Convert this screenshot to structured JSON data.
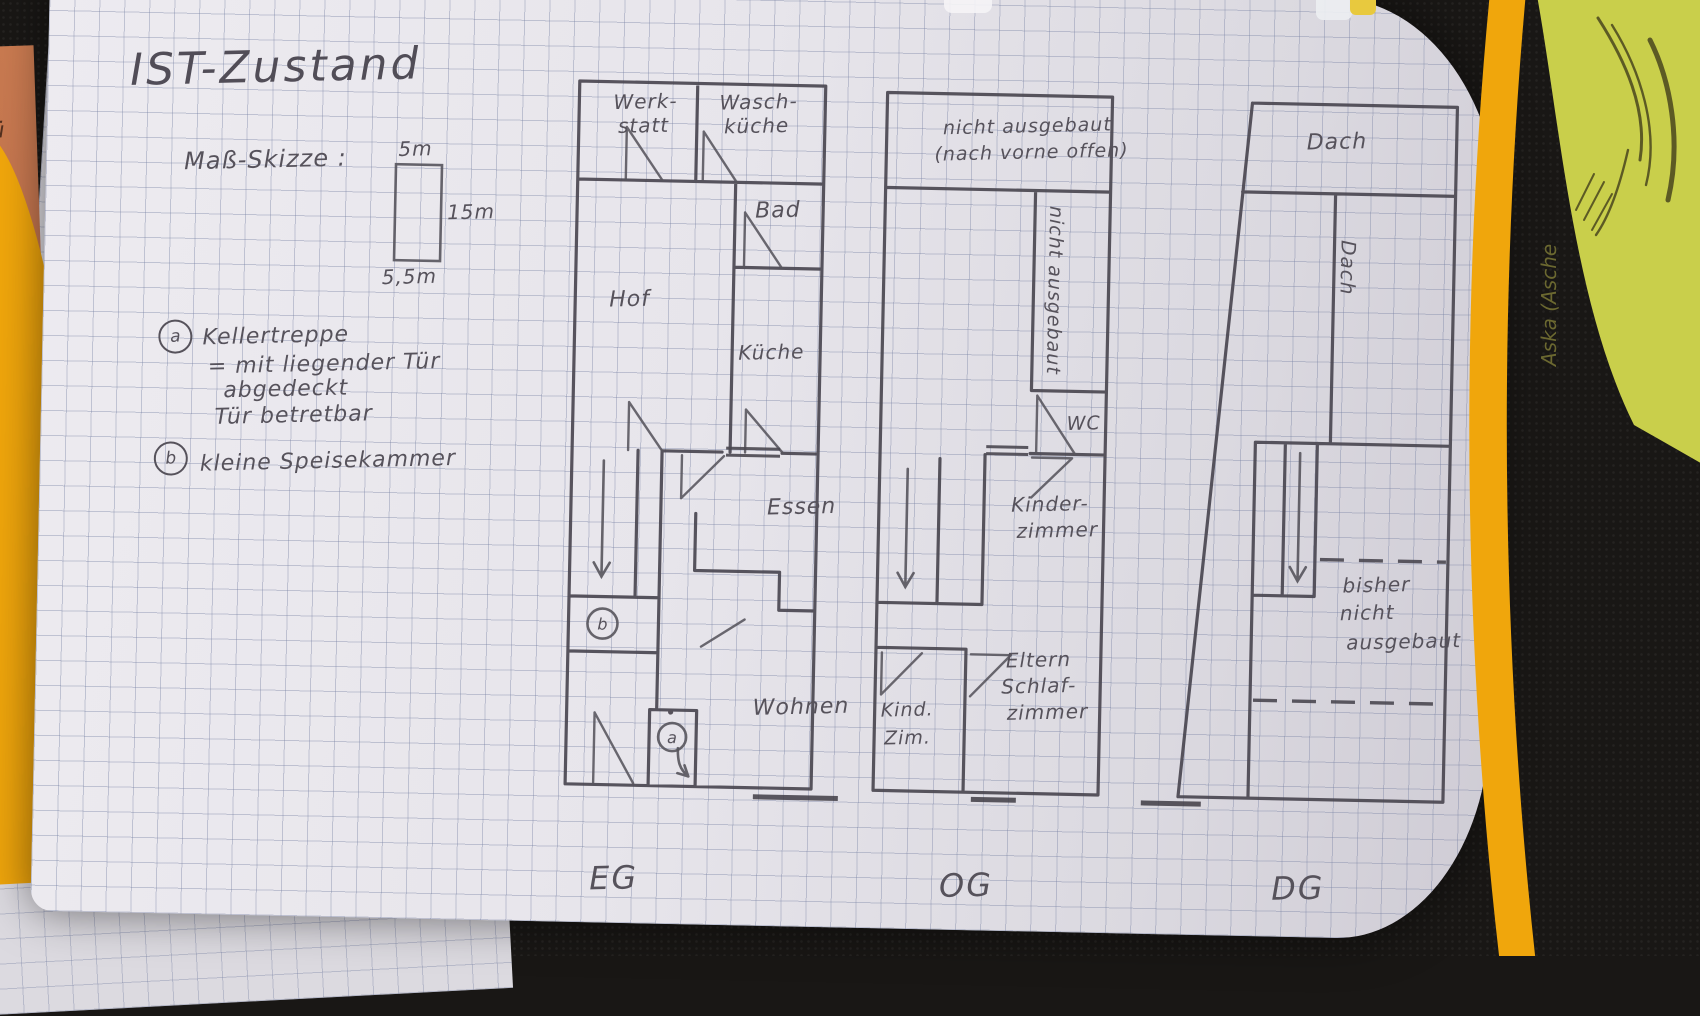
{
  "colors": {
    "pencil": "#56525b",
    "paper": "#e7e5eb",
    "grid_line": "#7680a2",
    "folder_yellow": "#f0a60c",
    "sticky_note_green": "#c9cf4b",
    "orange_note": "#c0714e",
    "background": "#191715"
  },
  "title": "IST-Zustand",
  "scale_sketch": {
    "label": "Maß-Skizze :",
    "top": "5m",
    "right": "15m",
    "bottom": "5,5m"
  },
  "legend": {
    "a_marker": "a",
    "a_line1": "Kellertreppe",
    "a_line2": "= mit liegender Tür",
    "a_line3": "abgedeckt",
    "a_line4": "Tür betretbar",
    "b_marker": "b",
    "b_line1": "kleine Speisekammer"
  },
  "plans": {
    "eg": {
      "floor_label": "EG",
      "werkstatt_l1": "Werk-",
      "werkstatt_l2": "statt",
      "waschkueche_l1": "Wasch-",
      "waschkueche_l2": "küche",
      "bad": "Bad",
      "hof": "Hof",
      "kueche": "Küche",
      "essen": "Essen",
      "wohnen": "Wohnen",
      "marker_a": "a",
      "marker_b": "b"
    },
    "og": {
      "floor_label": "OG",
      "attic_note_l1": "nicht ausgebaut",
      "attic_note_l2": "(nach vorne offen)",
      "side_note": "nicht ausgebaut",
      "wc": "WC",
      "kinderzimmer_l1": "Kinder-",
      "kinderzimmer_l2": "zimmer",
      "kind_zim_l1": "Kind.",
      "kind_zim_l2": "Zim.",
      "eltern_l1": "Eltern",
      "eltern_l2": "Schlaf-",
      "eltern_l3": "zimmer"
    },
    "dg": {
      "floor_label": "DG",
      "dach_top": "Dach",
      "dach_side": "Dach",
      "note_l1": "bisher",
      "note_l2": "nicht",
      "note_l3": "ausgebaut"
    }
  },
  "surroundings": {
    "sticky_note_text": "Aska (Asche",
    "orange_fragments": [
      "lü",
      "VS",
      "pfl",
      "il",
      "er"
    ]
  }
}
